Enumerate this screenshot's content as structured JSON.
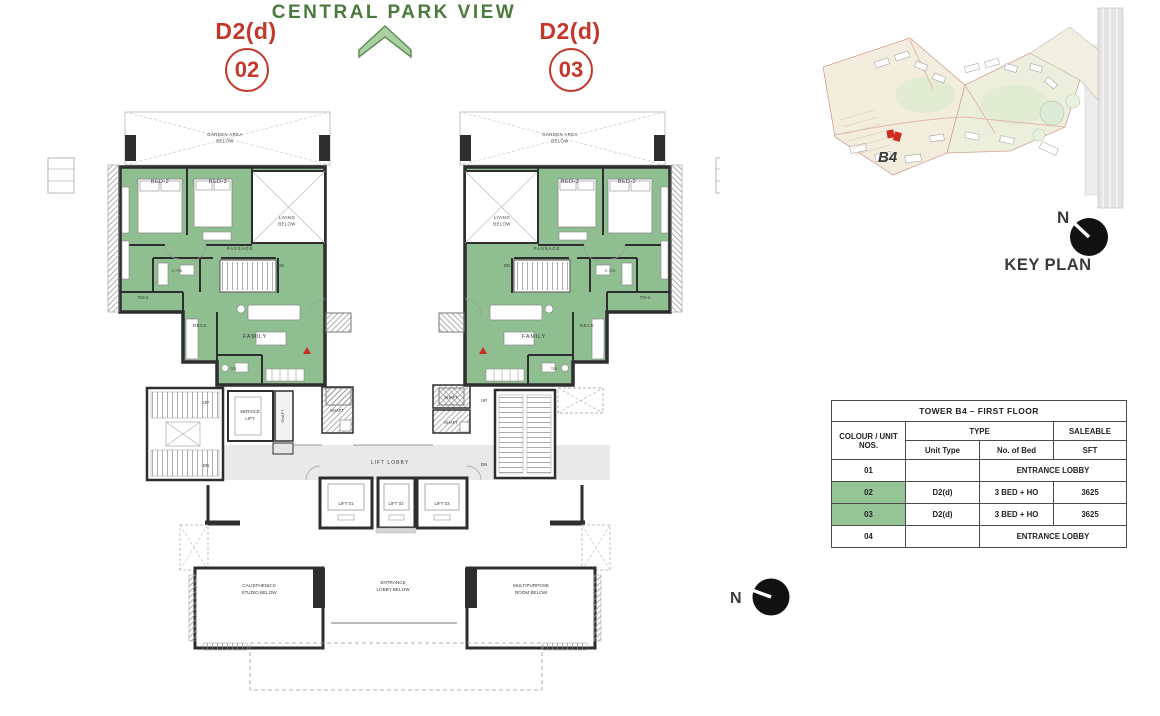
{
  "title": {
    "text": "CENTRAL PARK VIEW"
  },
  "unit_labels": {
    "left": {
      "type": "D2(d)",
      "number": "02"
    },
    "right": {
      "type": "D2(d)",
      "number": "03"
    }
  },
  "plan_labels": {
    "garden_l1": "GARDEN AREA",
    "garden_l2": "BELOW",
    "bed2": "BED-2",
    "bed3": "BED-3",
    "living_l1": "LIVING",
    "living_l2": "BELOW",
    "passage": "PASSAGE",
    "family": "FAMILY",
    "deck": "DECK",
    "toi": "TOI",
    "toi2": "TOI-2",
    "ctoi": "C.TOI",
    "up": "UP",
    "dn": "DN",
    "service_l1": "SERVICE",
    "service_l2": "LIFT",
    "shaft": "SHAFT",
    "lift_lobby": "LIFT LOBBY",
    "lift01": "LIFT 01",
    "lift02": "LIFT 02",
    "lift03": "LIFT 03",
    "cal_l1": "CALISTHENICS",
    "cal_l2": "STUDIO BELOW",
    "ent_l1": "ENTRANCE",
    "ent_l2": "LOBBY BELOW",
    "multi_l1": "MULTIPURPOSE",
    "multi_l2": "ROOM BELOW"
  },
  "key_plan": {
    "site_label": "B4",
    "north": "N",
    "caption": "KEY PLAN"
  },
  "compass": {
    "north": "N"
  },
  "table": {
    "title": "TOWER B4 – FIRST FLOOR",
    "col_unit": "COLOUR / UNIT NOS.",
    "col_type": "TYPE",
    "col_saleable": "SALEABLE",
    "col_unit_type": "Unit Type",
    "col_bed": "No. of Bed",
    "col_sft": "SFT",
    "rows": [
      {
        "unit": "01",
        "unit_type": "",
        "value": "ENTRANCE LOBBY",
        "highlight": false
      },
      {
        "unit": "02",
        "unit_type": "D2(d)",
        "bed": "3 BED + HO",
        "sft": "3625",
        "highlight": true
      },
      {
        "unit": "03",
        "unit_type": "D2(d)",
        "bed": "3 BED + HO",
        "sft": "3625",
        "highlight": true
      },
      {
        "unit": "04",
        "unit_type": "",
        "value": "ENTRANCE LOBBY",
        "highlight": false
      }
    ]
  },
  "colors": {
    "unit_green": "#8fbf90",
    "table_green": "#95c596",
    "title_green": "#4b7a3d",
    "chevron_fill": "#aacfa1",
    "chevron_stroke": "#5f8f55",
    "accent_red": "#c4382c",
    "wall": "#2e2e2e",
    "lobby_gray": "#e9e9e9"
  }
}
